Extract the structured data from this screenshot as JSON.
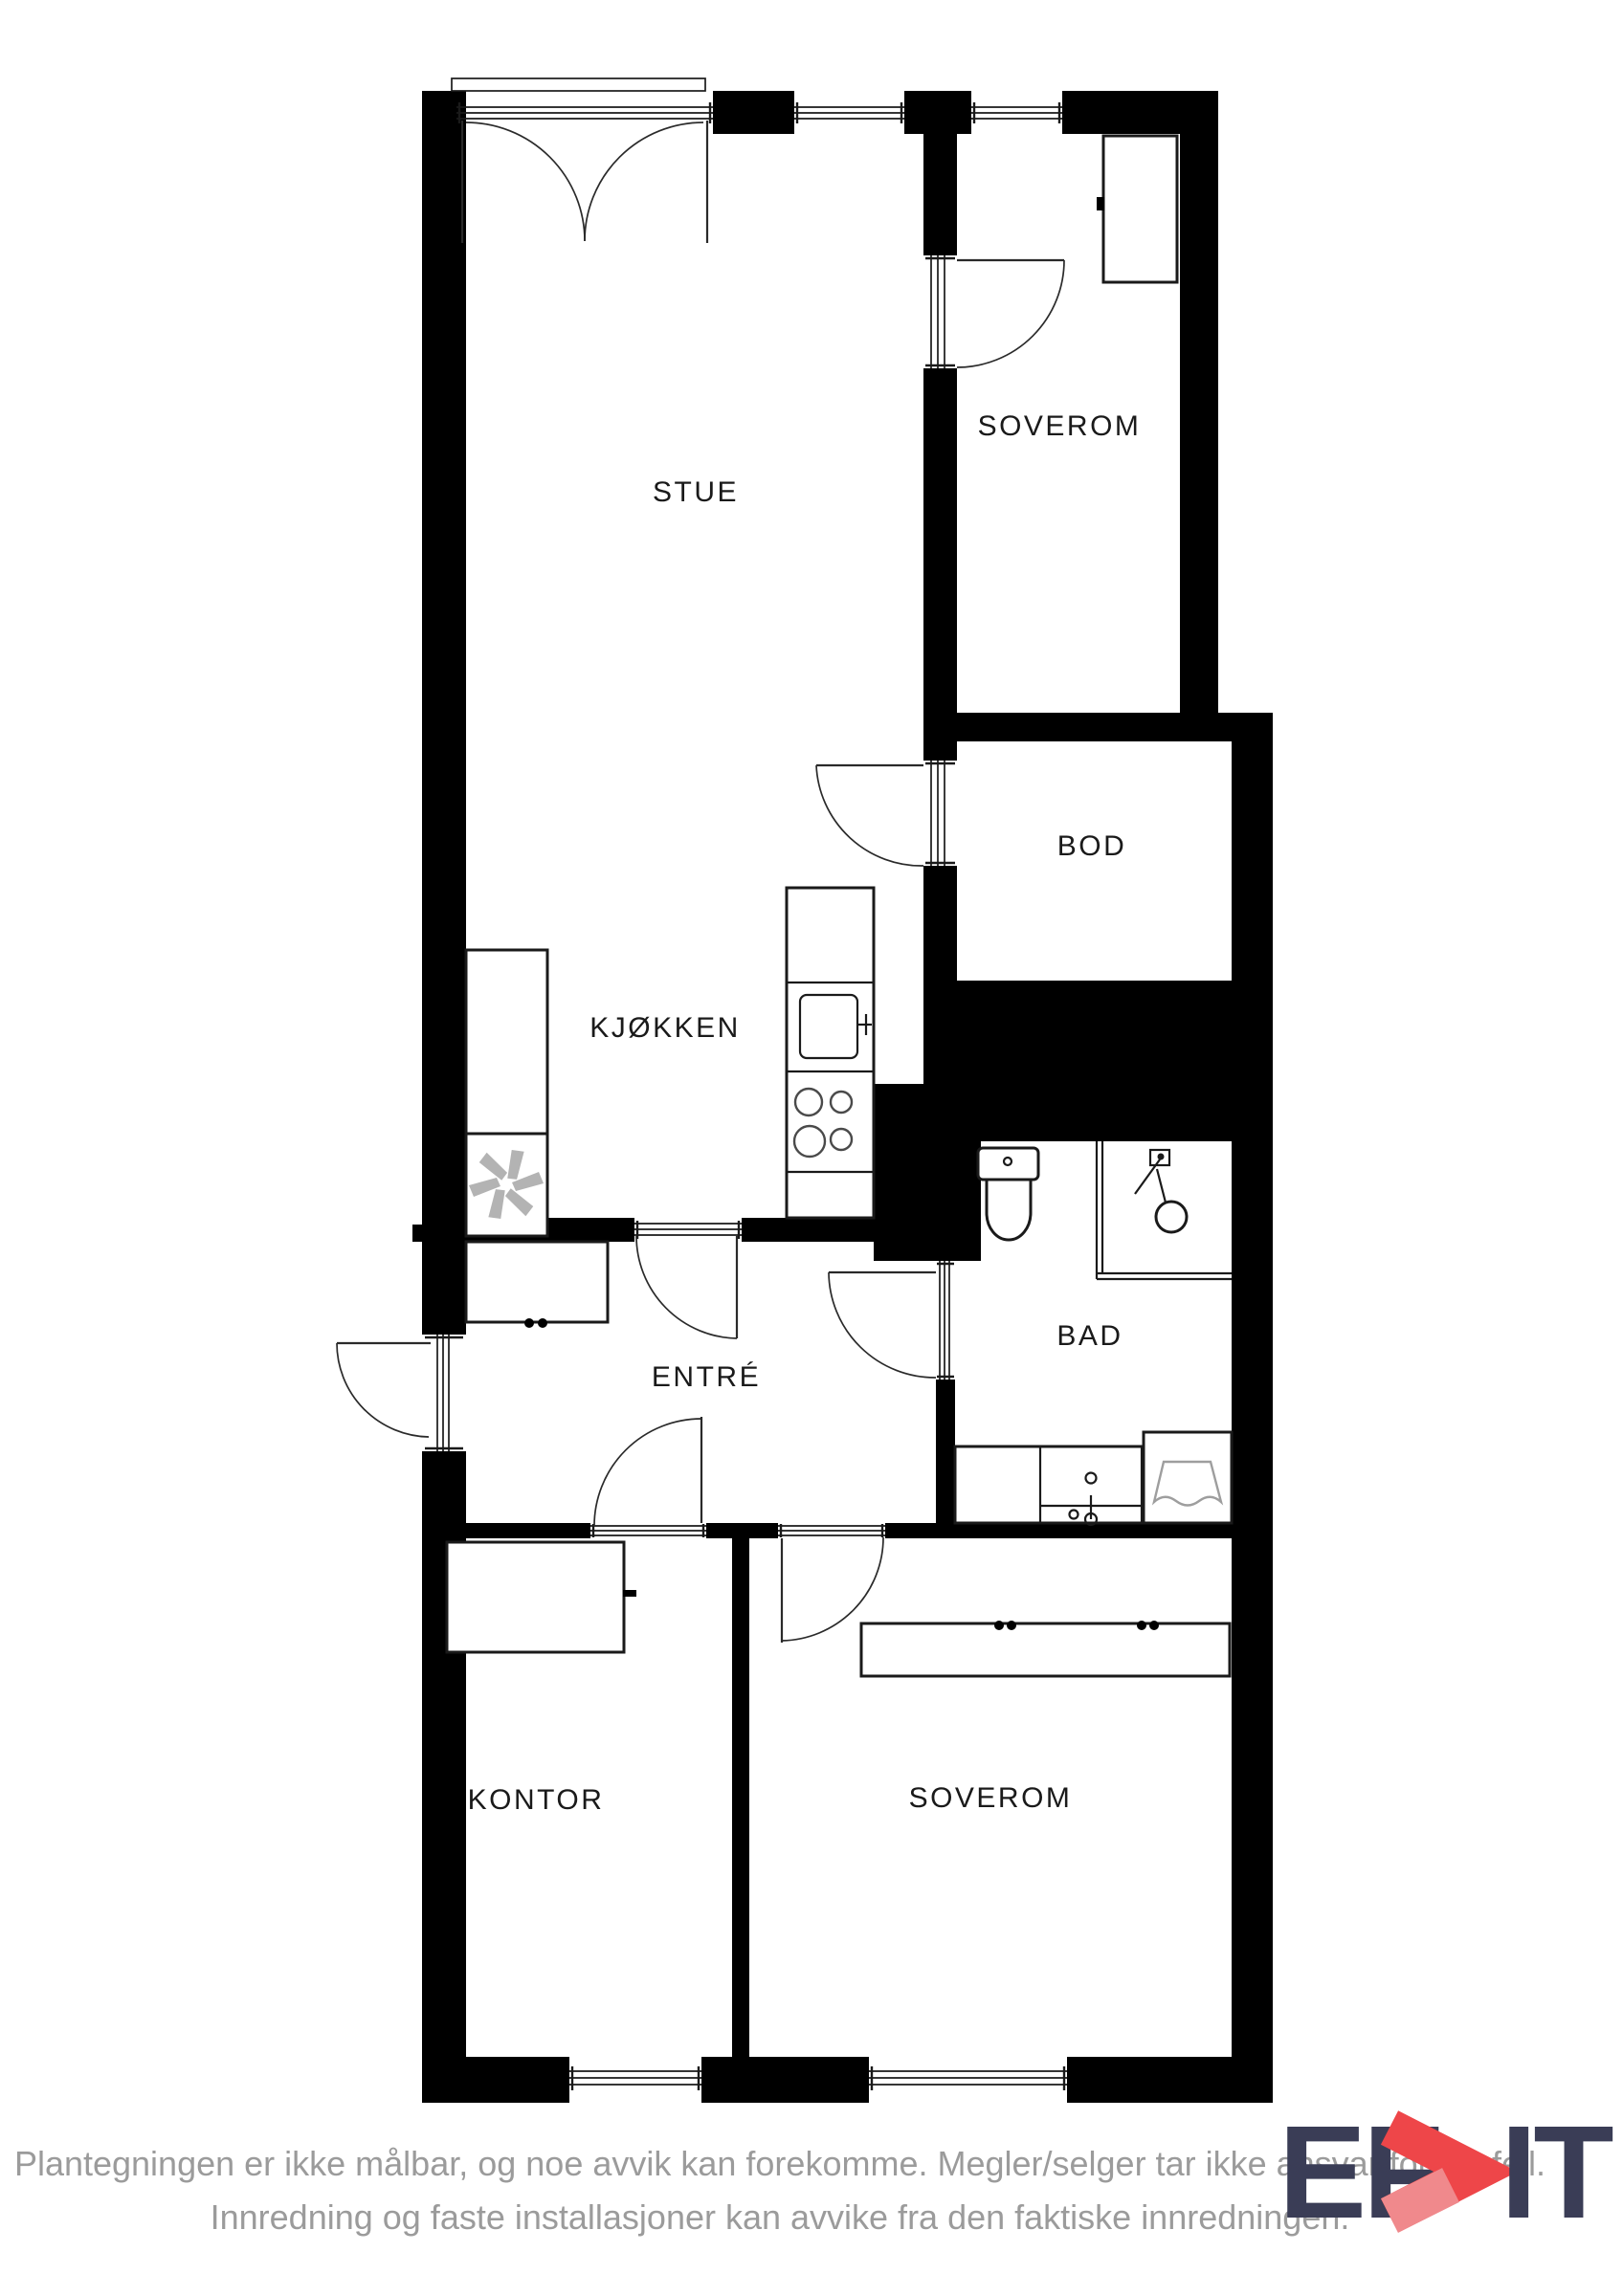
{
  "floorplan": {
    "rooms": {
      "stue": {
        "label": "STUE"
      },
      "soverom_top": {
        "label": "SOVEROM"
      },
      "bod": {
        "label": "BOD"
      },
      "kjokken": {
        "label": "KJØKKEN"
      },
      "bad": {
        "label": "BAD"
      },
      "entre": {
        "label": "ENTRÉ"
      },
      "kontor": {
        "label": "KONTOR"
      },
      "soverom_bottom": {
        "label": "SOVEROM"
      }
    },
    "fixtures": {
      "balcony_door": "double balcony door",
      "fan": "ventilation-fan-icon",
      "kitchen_sink": "kitchen-sink-icon",
      "stove": "stove-burners-icon",
      "toilet": "toilet-icon",
      "shower": "shower-icon",
      "bathroom_sink": "bathroom-sink-icon",
      "washing_machine": "washing-machine-icon",
      "wardrobe": "wardrobe"
    }
  },
  "footer": {
    "line1": "Plantegningen er ikke målbar, og noe avvik kan forekomme. Megler/selger tar ikke ansvar for ev. feil.",
    "line2": "Innredning og faste installasjoner kan avvike fra den faktiske innredningen."
  },
  "logo": {
    "left": "EF",
    "right": "IT"
  },
  "colors": {
    "wall": "#000000",
    "label": "#1a1a1a",
    "fixture_gray": "#b3b3b3",
    "footer": "#9b9b9b",
    "logo_navy": "#3a3d56",
    "logo_red": "#ee4649",
    "logo_red_light": "#f0898c"
  }
}
